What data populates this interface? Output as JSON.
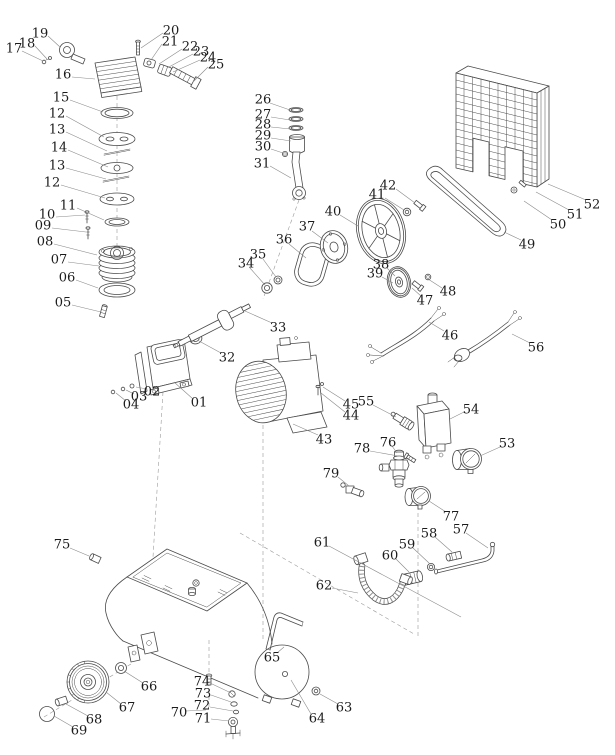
{
  "diagram": {
    "kind": "air-compressor-exploded-parts-diagram",
    "background": "#ffffff",
    "line_color": "#4a4a4a",
    "label_color": "#1b1b1b",
    "leader_color": "#8a8a8a",
    "parts": [
      {
        "num": "19",
        "x": 40,
        "y": 33,
        "leader": [
          48,
          36,
          60,
          47
        ]
      },
      {
        "num": "18",
        "x": 27,
        "y": 43,
        "leader": [
          35,
          46,
          47,
          59
        ]
      },
      {
        "num": "17",
        "x": 14,
        "y": 48,
        "leader": [
          22,
          51,
          43,
          61
        ]
      },
      {
        "num": "20",
        "x": 171,
        "y": 30,
        "leader": [
          163,
          33,
          141,
          48
        ]
      },
      {
        "num": "21",
        "x": 170,
        "y": 41,
        "leader": [
          162,
          44,
          151,
          60
        ]
      },
      {
        "num": "22",
        "x": 190,
        "y": 46,
        "leader": [
          182,
          49,
          159,
          64
        ]
      },
      {
        "num": "23",
        "x": 201,
        "y": 51,
        "leader": [
          193,
          54,
          167,
          68
        ]
      },
      {
        "num": "24",
        "x": 208,
        "y": 57,
        "leader": [
          200,
          60,
          173,
          72
        ]
      },
      {
        "num": "25",
        "x": 216,
        "y": 64,
        "leader": [
          208,
          67,
          193,
          82
        ]
      },
      {
        "num": "16",
        "x": 63,
        "y": 74,
        "leader": [
          72,
          77,
          95,
          79
        ]
      },
      {
        "num": "15",
        "x": 61,
        "y": 97,
        "leader": [
          70,
          100,
          103,
          112
        ]
      },
      {
        "num": "12",
        "x": 57,
        "y": 113,
        "leader": [
          66,
          116,
          104,
          137
        ]
      },
      {
        "num": "13",
        "x": 57,
        "y": 129,
        "leader": [
          66,
          132,
          107,
          151
        ]
      },
      {
        "num": "14",
        "x": 59,
        "y": 147,
        "leader": [
          68,
          150,
          108,
          167
        ]
      },
      {
        "num": "13",
        "x": 57,
        "y": 165,
        "leader": [
          66,
          168,
          106,
          179
        ]
      },
      {
        "num": "12",
        "x": 52,
        "y": 182,
        "leader": [
          61,
          185,
          105,
          198
        ]
      },
      {
        "num": "11",
        "x": 68,
        "y": 205,
        "leader": [
          77,
          208,
          104,
          220
        ]
      },
      {
        "num": "10",
        "x": 47,
        "y": 214,
        "leader": [
          56,
          217,
          85,
          215
        ]
      },
      {
        "num": "09",
        "x": 43,
        "y": 225,
        "leader": [
          52,
          228,
          86,
          232
        ]
      },
      {
        "num": "08",
        "x": 45,
        "y": 241,
        "leader": [
          54,
          244,
          97,
          255
        ]
      },
      {
        "num": "07",
        "x": 59,
        "y": 259,
        "leader": [
          68,
          262,
          99,
          266
        ]
      },
      {
        "num": "06",
        "x": 67,
        "y": 277,
        "leader": [
          76,
          280,
          98,
          288
        ]
      },
      {
        "num": "05",
        "x": 63,
        "y": 302,
        "leader": [
          72,
          305,
          101,
          312
        ]
      },
      {
        "num": "26",
        "x": 263,
        "y": 99,
        "leader": [
          270,
          103,
          290,
          110
        ]
      },
      {
        "num": "27",
        "x": 263,
        "y": 114,
        "leader": [
          271,
          117,
          290,
          120
        ]
      },
      {
        "num": "28",
        "x": 263,
        "y": 124,
        "leader": [
          271,
          127,
          290,
          129
        ]
      },
      {
        "num": "29",
        "x": 263,
        "y": 135,
        "leader": [
          271,
          138,
          291,
          141
        ]
      },
      {
        "num": "30",
        "x": 263,
        "y": 146,
        "leader": [
          271,
          149,
          283,
          153
        ]
      },
      {
        "num": "31",
        "x": 262,
        "y": 163,
        "leader": [
          270,
          166,
          291,
          178
        ]
      },
      {
        "num": "01",
        "x": 199,
        "y": 402,
        "leader": [
          193,
          399,
          174,
          382
        ]
      },
      {
        "num": "02",
        "x": 152,
        "y": 391,
        "leader": [
          147,
          389,
          136,
          387
        ]
      },
      {
        "num": "03",
        "x": 139,
        "y": 396,
        "leader": [
          134,
          394,
          126,
          390
        ]
      },
      {
        "num": "04",
        "x": 131,
        "y": 404,
        "leader": [
          126,
          401,
          116,
          393
        ]
      },
      {
        "num": "32",
        "x": 227,
        "y": 357,
        "leader": [
          221,
          353,
          199,
          341
        ]
      },
      {
        "num": "33",
        "x": 278,
        "y": 327,
        "leader": [
          272,
          323,
          245,
          311
        ]
      },
      {
        "num": "34",
        "x": 246,
        "y": 263,
        "leader": [
          250,
          268,
          265,
          285
        ]
      },
      {
        "num": "35",
        "x": 258,
        "y": 254,
        "leader": [
          263,
          259,
          276,
          277
        ]
      },
      {
        "num": "36",
        "x": 284,
        "y": 239,
        "leader": [
          289,
          244,
          306,
          258
        ]
      },
      {
        "num": "37",
        "x": 307,
        "y": 226,
        "leader": [
          312,
          231,
          328,
          243
        ]
      },
      {
        "num": "40",
        "x": 333,
        "y": 211,
        "leader": [
          340,
          215,
          358,
          226
        ]
      },
      {
        "num": "41",
        "x": 377,
        "y": 194,
        "leader": [
          385,
          198,
          404,
          210
        ]
      },
      {
        "num": "42",
        "x": 388,
        "y": 185,
        "leader": [
          396,
          189,
          415,
          203
        ]
      },
      {
        "num": "38",
        "x": 381,
        "y": 264,
        "leader": [
          387,
          268,
          395,
          276
        ]
      },
      {
        "num": "39",
        "x": 375,
        "y": 273,
        "leader": [
          382,
          277,
          393,
          283
        ]
      },
      {
        "num": "47",
        "x": 425,
        "y": 300,
        "leader": [
          421,
          296,
          412,
          288
        ]
      },
      {
        "num": "48",
        "x": 448,
        "y": 291,
        "leader": [
          442,
          288,
          428,
          279
        ]
      },
      {
        "num": "49",
        "x": 527,
        "y": 244,
        "leader": [
          521,
          240,
          504,
          232
        ]
      },
      {
        "num": "50",
        "x": 558,
        "y": 224,
        "leader": [
          552,
          220,
          524,
          201
        ]
      },
      {
        "num": "51",
        "x": 575,
        "y": 214,
        "leader": [
          569,
          210,
          536,
          192
        ]
      },
      {
        "num": "52",
        "x": 592,
        "y": 204,
        "leader": [
          586,
          200,
          548,
          184
        ]
      },
      {
        "num": "46",
        "x": 450,
        "y": 335,
        "leader": [
          444,
          331,
          429,
          322
        ]
      },
      {
        "num": "56",
        "x": 536,
        "y": 347,
        "leader": [
          530,
          343,
          512,
          334
        ]
      },
      {
        "num": "43",
        "x": 324,
        "y": 439,
        "leader": [
          318,
          435,
          293,
          424
        ]
      },
      {
        "num": "44",
        "x": 351,
        "y": 415,
        "leader": [
          345,
          412,
          321,
          393
        ]
      },
      {
        "num": "45",
        "x": 351,
        "y": 404,
        "leader": [
          345,
          401,
          323,
          387
        ]
      },
      {
        "num": "55",
        "x": 366,
        "y": 401,
        "leader": [
          373,
          405,
          396,
          417
        ]
      },
      {
        "num": "54",
        "x": 471,
        "y": 409,
        "leader": [
          464,
          412,
          450,
          419
        ]
      },
      {
        "num": "53",
        "x": 507,
        "y": 443,
        "leader": [
          500,
          447,
          480,
          456
        ]
      },
      {
        "num": "76",
        "x": 388,
        "y": 442,
        "leader": [
          392,
          446,
          397,
          453
        ]
      },
      {
        "num": "78",
        "x": 362,
        "y": 448,
        "leader": [
          370,
          451,
          404,
          457
        ]
      },
      {
        "num": "79",
        "x": 331,
        "y": 473,
        "leader": [
          338,
          477,
          349,
          486
        ]
      },
      {
        "num": "77",
        "x": 451,
        "y": 516,
        "leader": [
          446,
          512,
          429,
          501
        ]
      },
      {
        "num": "57",
        "x": 461,
        "y": 529,
        "leader": [
          466,
          533,
          488,
          548
        ]
      },
      {
        "num": "58",
        "x": 429,
        "y": 533,
        "leader": [
          435,
          537,
          452,
          552
        ]
      },
      {
        "num": "59",
        "x": 407,
        "y": 544,
        "leader": [
          413,
          548,
          429,
          563
        ]
      },
      {
        "num": "60",
        "x": 390,
        "y": 555,
        "leader": [
          396,
          559,
          409,
          572
        ]
      },
      {
        "num": "61",
        "x": 322,
        "y": 542,
        "leader": [
          329,
          546,
          461,
          617
        ]
      },
      {
        "num": "62",
        "x": 324,
        "y": 585,
        "leader": [
          332,
          588,
          358,
          593
        ]
      },
      {
        "num": "75",
        "x": 62,
        "y": 544,
        "leader": [
          70,
          548,
          89,
          556
        ]
      },
      {
        "num": "65",
        "x": 272,
        "y": 657,
        "leader": [
          277,
          653,
          284,
          647
        ]
      },
      {
        "num": "66",
        "x": 149,
        "y": 686,
        "leader": [
          143,
          683,
          124,
          671
        ]
      },
      {
        "num": "67",
        "x": 127,
        "y": 707,
        "leader": [
          121,
          704,
          106,
          692
        ]
      },
      {
        "num": "68",
        "x": 94,
        "y": 719,
        "leader": [
          88,
          716,
          66,
          704
        ]
      },
      {
        "num": "69",
        "x": 79,
        "y": 730,
        "leader": [
          73,
          727,
          54,
          716
        ]
      },
      {
        "num": "70",
        "x": 179,
        "y": 712,
        "leader": [
          186,
          711,
          206,
          710
        ]
      },
      {
        "num": "74",
        "x": 202,
        "y": 681,
        "leader": [
          210,
          683,
          229,
          692
        ]
      },
      {
        "num": "73",
        "x": 203,
        "y": 693,
        "leader": [
          211,
          695,
          231,
          702
        ]
      },
      {
        "num": "72",
        "x": 202,
        "y": 705,
        "leader": [
          210,
          707,
          233,
          711
        ]
      },
      {
        "num": "71",
        "x": 203,
        "y": 718,
        "leader": [
          211,
          719,
          229,
          721
        ]
      },
      {
        "num": "63",
        "x": 344,
        "y": 707,
        "leader": [
          338,
          704,
          320,
          694
        ]
      },
      {
        "num": "64",
        "x": 317,
        "y": 718,
        "leader": [
          311,
          714,
          291,
          680
        ]
      }
    ]
  }
}
